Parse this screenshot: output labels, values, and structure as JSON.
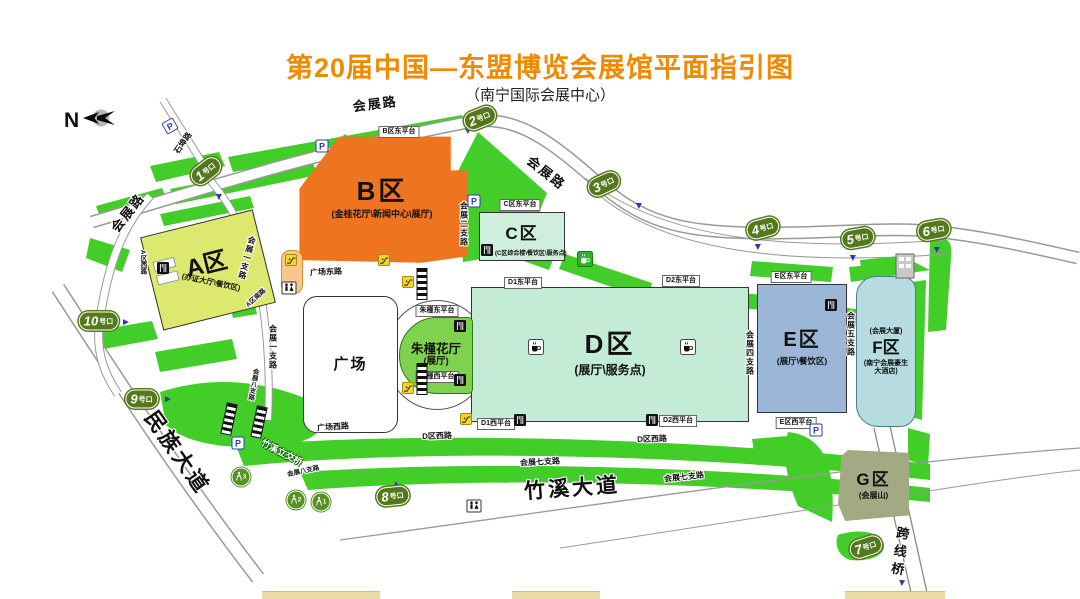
{
  "title": "第20届中国—东盟博览会展馆平面指引图",
  "subtitle": "（南宁国际会展中心）",
  "compass": {
    "label": "N"
  },
  "colors": {
    "title_orange": "#f08a00",
    "lawn_green": "#43cd28",
    "gate_green": "#54791c",
    "zone_A": "#dce86e",
    "zone_B": "#ef7420",
    "zone_C": "#cfeede",
    "zone_D": "#c3ebd6",
    "zone_E": "#9cb6d8",
    "zone_F": "#b6dce1",
    "zone_G": "#a2aa84",
    "zhujin_green": "#7ed24e"
  },
  "zones": {
    "A": {
      "label": "A区",
      "sub": "(办证大厅\\餐饮区)"
    },
    "B": {
      "label": "B区",
      "sub": "(金桂花厅\\新闻中心\\展厅)"
    },
    "C": {
      "label": "C区",
      "sub": "(C区综合楼\\餐饮区\\服务点)"
    },
    "D": {
      "label": "D区",
      "sub": "(展厅\\服务点)"
    },
    "E": {
      "label": "E区",
      "sub": "(展厅\\餐饮区)"
    },
    "F": {
      "label": "F区",
      "sub_top": "(会展大厦)",
      "sub_bottom": "(南宁会展豪生大酒店)"
    },
    "G": {
      "label": "G区",
      "sub": "(会展山)"
    },
    "plaza": {
      "label": "广场"
    },
    "zhujin": {
      "label": "朱槿花厅",
      "sub": "(展厅)"
    }
  },
  "gates": {
    "suffix": "号口",
    "items": [
      {
        "num": "1",
        "x": 206,
        "y": 171,
        "rot": -38
      },
      {
        "num": "2",
        "x": 480,
        "y": 118,
        "rot": -22
      },
      {
        "num": "3",
        "x": 604,
        "y": 184,
        "rot": -25
      },
      {
        "num": "4",
        "x": 763,
        "y": 228,
        "rot": -15
      },
      {
        "num": "5",
        "x": 858,
        "y": 238,
        "rot": -10
      },
      {
        "num": "6",
        "x": 934,
        "y": 230,
        "rot": -10
      },
      {
        "num": "7",
        "x": 866,
        "y": 547,
        "rot": -18
      },
      {
        "num": "8",
        "x": 393,
        "y": 496,
        "rot": -6
      },
      {
        "num": "9",
        "x": 142,
        "y": 399,
        "rot": 0
      },
      {
        "num": "10",
        "x": 99,
        "y": 321,
        "rot": 0
      }
    ]
  },
  "pedestrian_gates": [
    {
      "num": "1",
      "x": 321,
      "y": 502
    },
    {
      "num": "2",
      "x": 296,
      "y": 500
    },
    {
      "num": "3",
      "x": 241,
      "y": 477
    }
  ],
  "roads": [
    {
      "text": "会展路",
      "x": 375,
      "y": 103,
      "rot": -7,
      "cls": "big halo"
    },
    {
      "text": "会展路",
      "x": 127,
      "y": 212,
      "rot": -52,
      "cls": "big halo"
    },
    {
      "text": "会展路",
      "x": 547,
      "y": 172,
      "rot": 38,
      "cls": "big halo"
    },
    {
      "text": "石埠路",
      "x": 183,
      "y": 143,
      "rot": -55,
      "cls": "small halo"
    },
    {
      "text": "民族大道",
      "x": 178,
      "y": 452,
      "rot": 55,
      "cls": "huge halo"
    },
    {
      "text": "竹溪大道",
      "x": 572,
      "y": 487,
      "rot": -4,
      "cls": "huge halo"
    },
    {
      "text": "跨线桥",
      "x": 899,
      "y": 553,
      "rot": 8,
      "cls": "big-vert halo"
    },
    {
      "text": "竹溪立交桥",
      "x": 282,
      "y": 452,
      "rot": 28,
      "cls": "white-on-green"
    },
    {
      "text": "会展一支路",
      "x": 247,
      "y": 258,
      "rot": 15,
      "cls": "small-vert halo"
    },
    {
      "text": "会展一支路",
      "x": 273,
      "y": 347,
      "rot": 0,
      "cls": "small-vert halo"
    },
    {
      "text": "会展二支路",
      "x": 464,
      "y": 224,
      "rot": 0,
      "cls": "small-vert halo"
    },
    {
      "text": "会展四支路",
      "x": 750,
      "y": 353,
      "rot": 0,
      "cls": "small-vert halo"
    },
    {
      "text": "会展五支路",
      "x": 851,
      "y": 334,
      "rot": 0,
      "cls": "small-vert halo"
    },
    {
      "text": "会展七支路",
      "x": 540,
      "y": 462,
      "rot": -3,
      "cls": "small halo"
    },
    {
      "text": "会展七支路",
      "x": 684,
      "y": 477,
      "rot": -6,
      "cls": "small halo"
    },
    {
      "text": "会展八支路",
      "x": 252,
      "y": 384,
      "rot": 10,
      "cls": "tiny-vert halo"
    },
    {
      "text": "会展八支路",
      "x": 303,
      "y": 470,
      "rot": -12,
      "cls": "tiny halo"
    },
    {
      "text": "A区西路",
      "x": 142,
      "y": 262,
      "rot": 0,
      "cls": "tiny-vert halo"
    },
    {
      "text": "A区南路",
      "x": 255,
      "y": 297,
      "rot": -42,
      "cls": "tiny halo"
    },
    {
      "text": "D区西路",
      "x": 437,
      "y": 436,
      "rot": -2,
      "cls": "small halo"
    },
    {
      "text": "D区西路",
      "x": 652,
      "y": 439,
      "rot": -2,
      "cls": "small halo"
    },
    {
      "text": "广场西路",
      "x": 333,
      "y": 427,
      "rot": -4,
      "cls": "small halo"
    },
    {
      "text": "广场东路",
      "x": 326,
      "y": 272,
      "rot": -3,
      "cls": "small halo"
    }
  ],
  "platforms": [
    {
      "text": "B区东平台",
      "x": 399,
      "y": 132
    },
    {
      "text": "C区东平台",
      "x": 520,
      "y": 205
    },
    {
      "text": "D1东平台",
      "x": 523,
      "y": 283
    },
    {
      "text": "D2东平台",
      "x": 681,
      "y": 281
    },
    {
      "text": "D1西平台",
      "x": 496,
      "y": 424
    },
    {
      "text": "D2西平台",
      "x": 678,
      "y": 421
    },
    {
      "text": "E区东平台",
      "x": 791,
      "y": 277
    },
    {
      "text": "E区西平台",
      "x": 796,
      "y": 423
    },
    {
      "text": "朱槿东平台",
      "x": 437,
      "y": 311
    },
    {
      "text": "朱槿西平台",
      "x": 437,
      "y": 377
    }
  ],
  "icons": [
    {
      "type": "parking",
      "x": 170,
      "y": 126,
      "rot": -30
    },
    {
      "type": "parking",
      "x": 322,
      "y": 146,
      "rot": 0
    },
    {
      "type": "parking",
      "x": 474,
      "y": 201,
      "rot": 0
    },
    {
      "type": "parking",
      "x": 238,
      "y": 443,
      "rot": 0
    },
    {
      "type": "parking",
      "x": 816,
      "y": 430,
      "rot": 0
    },
    {
      "type": "toilet",
      "x": 289,
      "y": 288,
      "rot": 0
    },
    {
      "type": "toilet",
      "x": 474,
      "y": 506,
      "rot": 0
    },
    {
      "type": "restaurant",
      "x": 163,
      "y": 268,
      "rot": 0
    },
    {
      "type": "restaurant",
      "x": 487,
      "y": 250,
      "rot": 0
    },
    {
      "type": "restaurant",
      "x": 460,
      "y": 326,
      "rot": 0
    },
    {
      "type": "restaurant",
      "x": 460,
      "y": 380,
      "rot": 0
    },
    {
      "type": "restaurant",
      "x": 520,
      "y": 420,
      "rot": 0
    },
    {
      "type": "restaurant",
      "x": 652,
      "y": 420,
      "rot": 0
    },
    {
      "type": "restaurant",
      "x": 831,
      "y": 305,
      "rot": 0
    },
    {
      "type": "coffee",
      "x": 536,
      "y": 347,
      "rot": 0
    },
    {
      "type": "coffee",
      "x": 688,
      "y": 347,
      "rot": 0
    },
    {
      "type": "coffee-green",
      "x": 585,
      "y": 259,
      "rot": 0
    },
    {
      "type": "escalator",
      "x": 291,
      "y": 260,
      "rot": 0
    },
    {
      "type": "escalator",
      "x": 384,
      "y": 260,
      "rot": 0
    },
    {
      "type": "escalator",
      "x": 408,
      "y": 282,
      "rot": 0
    },
    {
      "type": "escalator",
      "x": 408,
      "y": 388,
      "rot": 0
    },
    {
      "type": "escalator",
      "x": 466,
      "y": 419,
      "rot": 0
    },
    {
      "type": "crosswalk-v",
      "x": 422,
      "y": 284,
      "rot": 0
    },
    {
      "type": "crosswalk-v",
      "x": 422,
      "y": 379,
      "rot": 0
    },
    {
      "type": "crosswalk-v",
      "x": 229,
      "y": 419,
      "rot": 12
    },
    {
      "type": "crosswalk-v",
      "x": 259,
      "y": 422,
      "rot": 12
    },
    {
      "type": "building",
      "x": 905,
      "y": 266,
      "rot": 0
    },
    {
      "type": "arrow",
      "x": 218,
      "y": 197,
      "rot": 90
    },
    {
      "type": "arrow",
      "x": 467,
      "y": 131,
      "rot": 90
    },
    {
      "type": "arrow",
      "x": 638,
      "y": 206,
      "rot": 90
    },
    {
      "type": "arrow",
      "x": 757,
      "y": 247,
      "rot": 90
    },
    {
      "type": "arrow",
      "x": 852,
      "y": 258,
      "rot": 90
    },
    {
      "type": "arrow",
      "x": 936,
      "y": 250,
      "rot": 90
    },
    {
      "type": "arrow",
      "x": 397,
      "y": 484,
      "rot": -90
    },
    {
      "type": "arrow",
      "x": 168,
      "y": 400,
      "rot": 0
    },
    {
      "type": "arrow",
      "x": 126,
      "y": 323,
      "rot": 0
    },
    {
      "type": "arrow",
      "x": 901,
      "y": 583,
      "rot": 95
    }
  ]
}
